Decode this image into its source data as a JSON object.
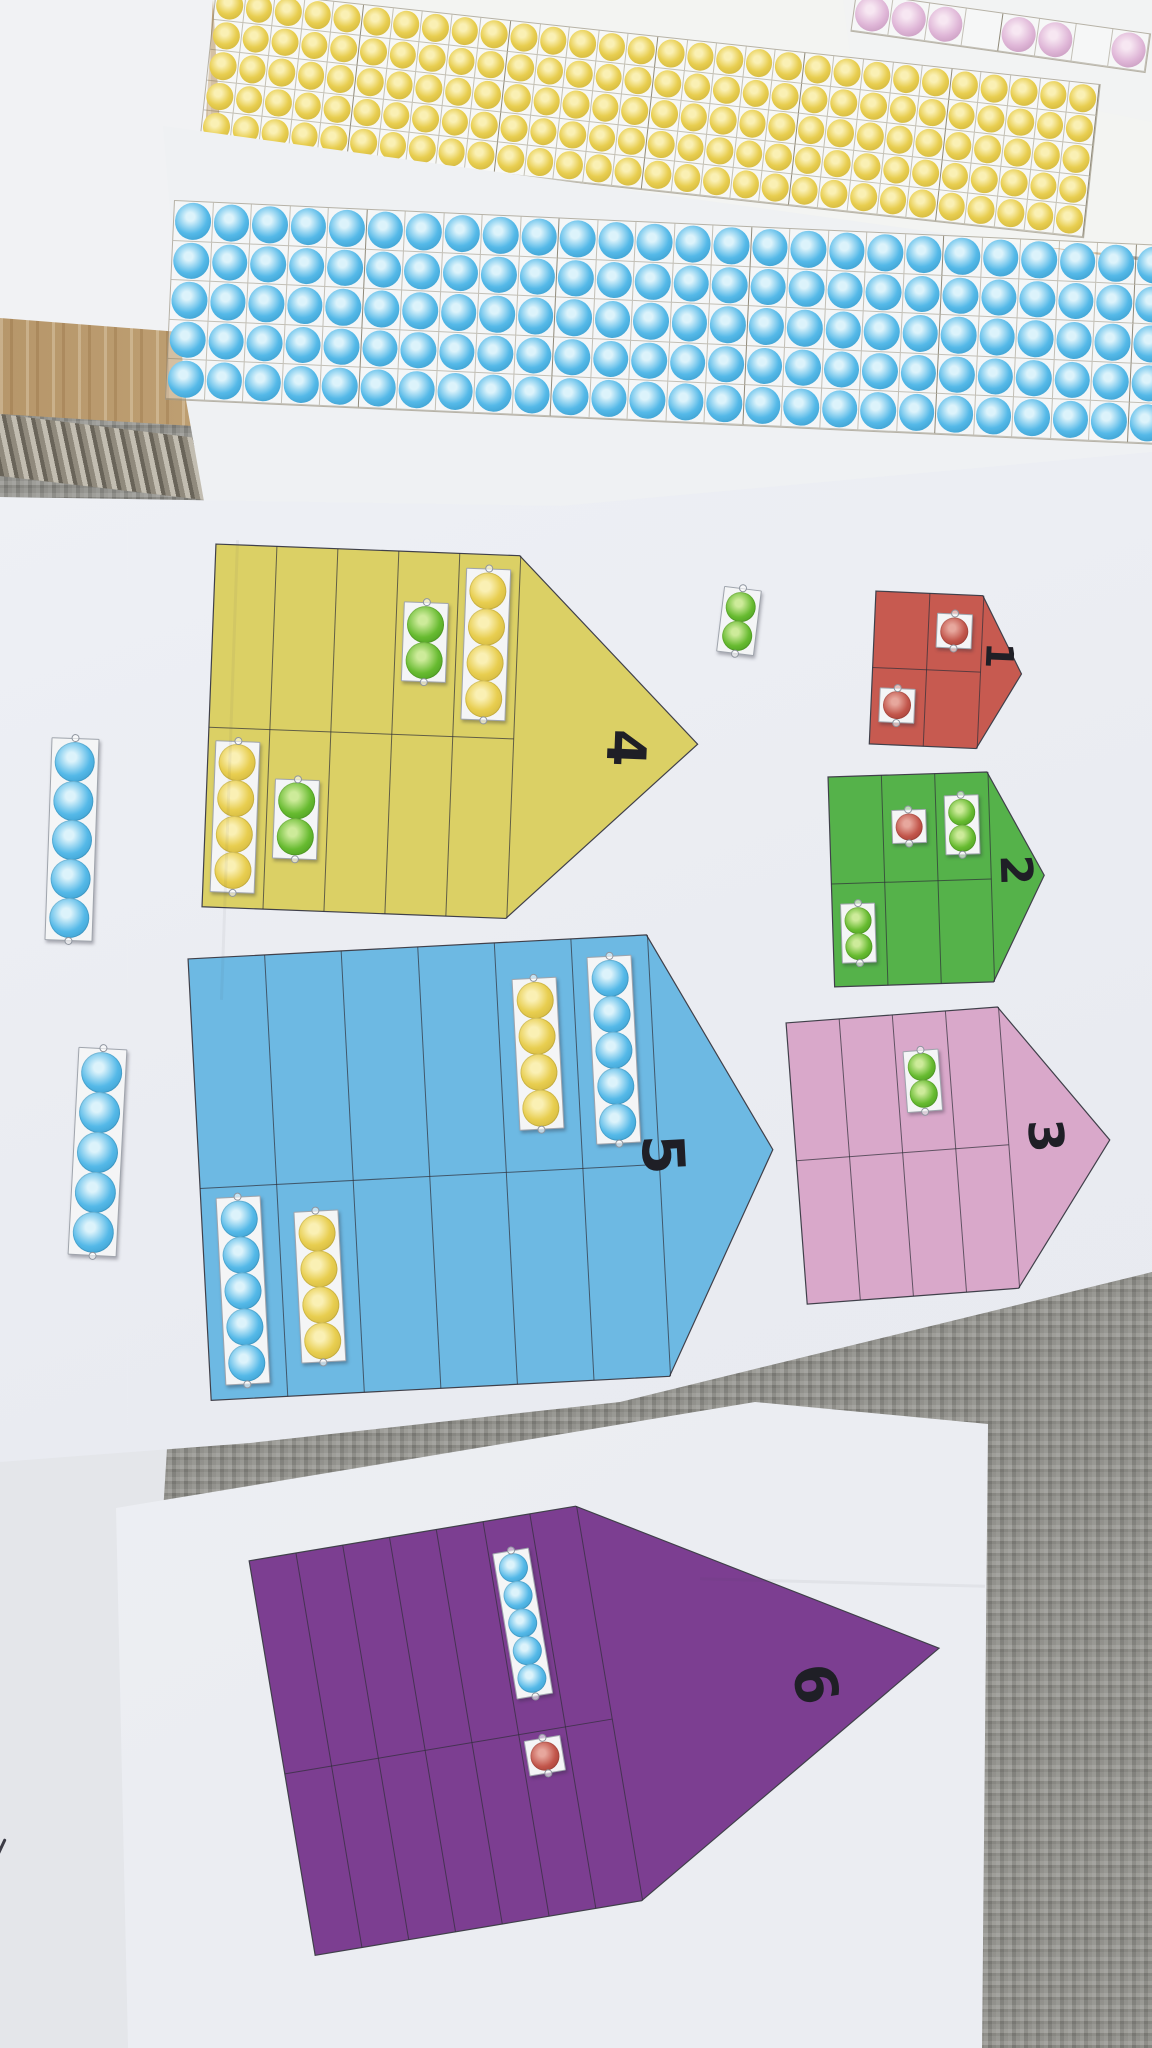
{
  "scene_title": "Printed number-pencil boards 1-6 with bead strips on rug",
  "palette": {
    "rug": "#90908b",
    "rug_border": "#8e887b",
    "wood_floor": "#c3a477",
    "paper": "#eff1f4",
    "print_line": "#35353f",
    "digit_color": "#1f1f26"
  },
  "dot_colors": {
    "yellow": "#e8ce50",
    "blue": "#55b9e8",
    "green": "#67bb30",
    "red": "#c2564b",
    "pink": "#dfb6d7"
  },
  "bead_sheets": [
    {
      "name": "pink-bead-row",
      "rows": 1,
      "cols": 8,
      "color": "pink",
      "empty_cells": [
        3,
        6
      ],
      "block_size": 5,
      "block_offset": 3
    },
    {
      "name": "yellow-bead-grid",
      "rows": 5,
      "cols": 30,
      "color": "yellow",
      "empty_cells": [],
      "block_size": 5,
      "block_offset": 4
    },
    {
      "name": "blue-bead-grid",
      "rows": 5,
      "cols": 27,
      "color": "blue",
      "empty_cells": [],
      "block_size": 5,
      "block_offset": 4
    }
  ],
  "pencils": [
    {
      "number": "1",
      "color_name": "red",
      "fill": "#c75a50",
      "rows": 2,
      "columns": 2,
      "strips": [
        {
          "row": 1,
          "col": 2,
          "count": 1,
          "color": "red"
        },
        {
          "row": 2,
          "col": 1,
          "count": 1,
          "color": "red"
        }
      ]
    },
    {
      "number": "2",
      "color_name": "green",
      "fill": "#55b24a",
      "rows": 2,
      "columns": 3,
      "strips": [
        {
          "row": 1,
          "col": 2,
          "count": 1,
          "color": "red"
        },
        {
          "row": 1,
          "col": 3,
          "count": 2,
          "color": "green"
        },
        {
          "row": 2,
          "col": 1,
          "count": 2,
          "color": "green"
        }
      ]
    },
    {
      "number": "3",
      "color_name": "pink",
      "fill": "#d9a8ca",
      "rows": 2,
      "columns": 4,
      "strips": [
        {
          "row": 1,
          "col": 3,
          "count": 2,
          "color": "green"
        }
      ]
    },
    {
      "number": "4",
      "color_name": "yellow",
      "fill": "#dbd065",
      "rows": 2,
      "columns": 5,
      "strips": [
        {
          "row": 1,
          "col": 4,
          "count": 2,
          "color": "green"
        },
        {
          "row": 1,
          "col": 5,
          "count": 4,
          "color": "yellow"
        },
        {
          "row": 2,
          "col": 1,
          "count": 4,
          "color": "yellow"
        },
        {
          "row": 2,
          "col": 2,
          "count": 2,
          "color": "green"
        }
      ]
    },
    {
      "number": "5",
      "color_name": "blue",
      "fill": "#6db9e3",
      "rows": 2,
      "columns": 6,
      "strips": [
        {
          "row": 1,
          "col": 5,
          "count": 4,
          "color": "yellow"
        },
        {
          "row": 1,
          "col": 6,
          "count": 5,
          "color": "blue"
        },
        {
          "row": 2,
          "col": 1,
          "count": 5,
          "color": "blue"
        },
        {
          "row": 2,
          "col": 2,
          "count": 4,
          "color": "yellow"
        }
      ]
    },
    {
      "number": "6",
      "color_name": "purple",
      "fill": "#7c3e91",
      "rows": 2,
      "columns": 7,
      "strips": [
        {
          "row": 1,
          "col": 6,
          "count": 5,
          "color": "blue"
        },
        {
          "row": 2,
          "col": 6,
          "count": 1,
          "color": "red",
          "align": "top"
        }
      ]
    }
  ],
  "loose_strips": [
    {
      "count": 2,
      "color": "green"
    },
    {
      "count": 5,
      "color": "blue"
    },
    {
      "count": 5,
      "color": "blue"
    }
  ]
}
